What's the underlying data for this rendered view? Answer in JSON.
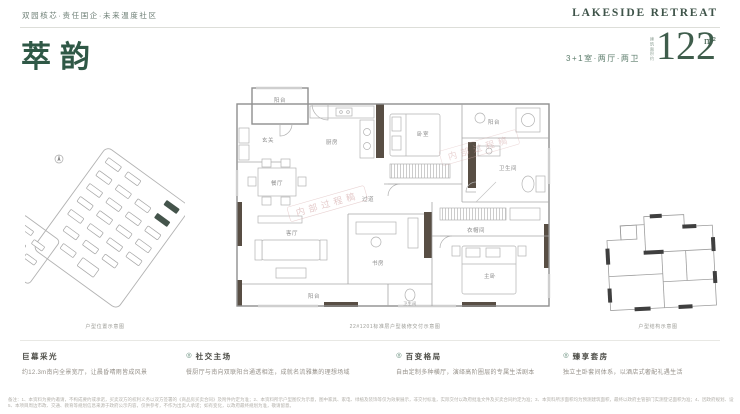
{
  "header": {
    "tagline": "双园核芯·责任国企·未来温度社区",
    "brand": "LAKESIDE RETREAT"
  },
  "unit": {
    "name": "萃韵",
    "layout": "3+1室·两厅·两卫",
    "area_label": "建筑面积约",
    "area_value": "122",
    "area_unit": "m²"
  },
  "plan": {
    "rooms": [
      "阳台",
      "玄关",
      "厨房",
      "卧室",
      "阳台",
      "卫生间",
      "过道",
      "餐厅",
      "客厅",
      "阳台",
      "书房",
      "衣帽间",
      "主卧",
      "卫生间"
    ],
    "watermark": "内部过程稿"
  },
  "captions": {
    "left": "户型位置示意图",
    "center": "22#1201标准层户型装修交付示意图",
    "right": "户型结构示意图"
  },
  "features": [
    {
      "title": "巨幕采光",
      "desc": "约12.3m南向全景宽厅，让晨昏晴雨皆成风景"
    },
    {
      "title": "社交主场",
      "desc": "餐厨厅与南向双联阳台通透相连，成就名流雅集的理想场域"
    },
    {
      "title": "百变格局",
      "desc": "自由定制多种横厅，演绎高阶圈层的专属生活剧本"
    },
    {
      "title": "臻享套房",
      "desc": "独立主卧套间体系，以酒店式奢配礼遇生活"
    }
  ],
  "ui": {
    "feature_icon": "◎"
  },
  "disclaimer": {
    "line1": "备注：1、本资料为要约邀请，不构成要约或承诺，买卖双方的权利义务以双方签署的《商品房买卖合同》及附件约定为准；2、本资料所示户型图仅为示意，图中家具、家电、绿植及装饰等仅为效果展示，非交付标准，实际交付以政府批准文件及买卖合同约定为准；3、本资料所涉面积均为预测建筑面积，最终以政府主管部门实测登记面积为准；4、因政府规划、设计调整等原因，项目实际情况可能发生变化，出卖人保留修改本资料的权利，敬请知悉。",
    "line2": "5、本项目周边市政、交通、教育等规划信息来源于政府公示内容，仅供参考，不作为出卖人承诺；如有变化，以政府最终规划为准，敬请留意。"
  },
  "colors": {
    "accent_green": "#2f5846",
    "icon_green": "#55806d",
    "wall_dark": "#584e44",
    "line_gray": "#8f8f8f",
    "caption_gray": "#9b9b95",
    "watermark_pink": "#cf9f9f"
  }
}
